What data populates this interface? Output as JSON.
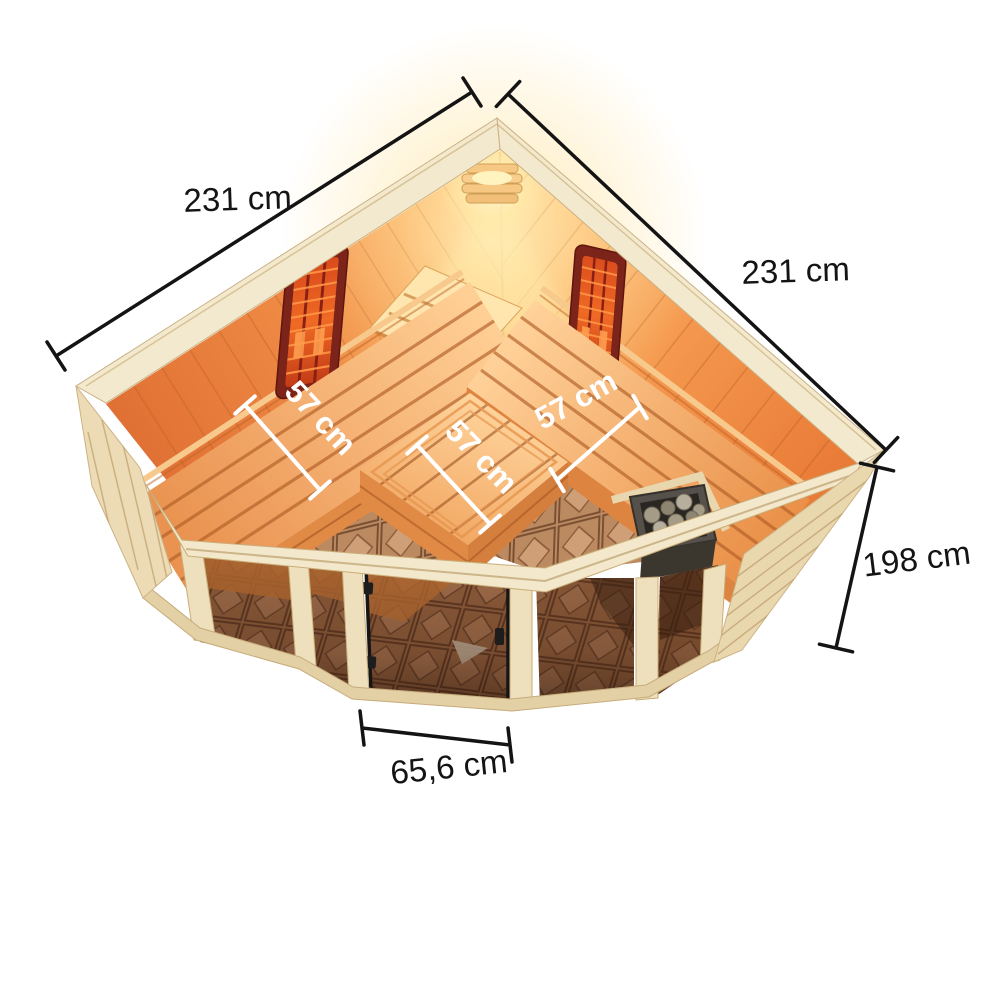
{
  "diagram": {
    "dimension_labels": {
      "width_left": "231 cm",
      "width_right": "231 cm",
      "height": "198 cm",
      "door_width": "65,6 cm",
      "bench_depth_left": "57 cm",
      "bench_depth_center": "57 cm",
      "bench_depth_right": "57 cm"
    },
    "colors": {
      "background": "#ffffff",
      "dimension_line": "#141414",
      "dimension_text": "#141414",
      "bench_dimension": "#ffffff",
      "wood_exterior": "#ecdbb4",
      "wood_rim": "#f2e9ce",
      "wood_frame": "#eee0bd",
      "interior_wall": "#f29048",
      "interior_glow": "#ffe2ac",
      "bench_wood": "#f7b97c",
      "bench_slat_gap": "#c97a3a",
      "heater_panel_frame": "#7c231a",
      "heater_panel_core": "#e05a20",
      "stove_body": "#4a463c",
      "stove_stones": "#a39a86",
      "glass_tint": "#5c3016",
      "floor_tile": "#a06e48",
      "floor_tile_line": "#5f3c28",
      "door_frame": "#151515"
    }
  }
}
